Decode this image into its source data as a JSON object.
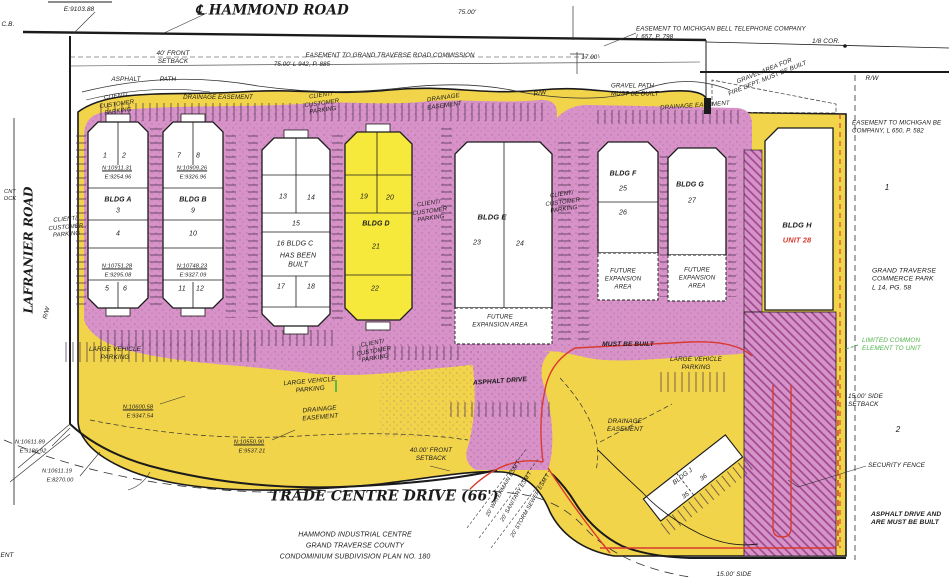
{
  "colors": {
    "site_yellow": "#F2D44B",
    "building_yellow": "#F6E93C",
    "parking_pink": "#D792C8",
    "hatch_line": "#A2418F",
    "ink": "#1B1B1B",
    "red": "#D83A2E",
    "green": "#4FB548"
  },
  "labels": [
    {
      "id": "coord-e9103",
      "text": "E:9103.88",
      "x": 79,
      "y": 10,
      "size": 6.5
    },
    {
      "id": "cb",
      "text": "C.B.",
      "x": 8,
      "y": 25,
      "size": 6.5
    },
    {
      "id": "hammond-road",
      "text": "℄ HAMMOND ROAD",
      "x": 272,
      "y": 11,
      "size": 13.5,
      "family": "serif",
      "weight": 700
    },
    {
      "id": "dim-75",
      "text": "75.00'",
      "x": 467,
      "y": 13,
      "size": 6.5
    },
    {
      "id": "setback-40-top",
      "text": "40' FRONT\nSETBACK",
      "x": 173,
      "y": 58,
      "size": 6.4
    },
    {
      "id": "esmt-road-commission",
      "text": "EASEMENT TO GRAND TRAVERSE ROAD COMMISSION",
      "x": 390,
      "y": 56,
      "size": 6.2
    },
    {
      "id": "esmt-road-ref",
      "text": "75.00'   L 942, P. 885",
      "x": 302,
      "y": 65,
      "size": 6.2
    },
    {
      "id": "esmt-bell-phone",
      "text": "EASEMENT TO MICHIGAN BELL TELEPHONE COMPANY\nL 657, P. 798",
      "x": 636,
      "y": 33,
      "size": 6.2,
      "align": "l"
    },
    {
      "id": "dim-17",
      "text": "17.00'",
      "x": 590,
      "y": 58,
      "size": 6.2
    },
    {
      "id": "cor-eighth",
      "text": "1/8 COR.",
      "x": 826,
      "y": 42,
      "size": 6.5
    },
    {
      "id": "gravel-area",
      "text": "GRAVEL AREA FOR\nFIRE DEPT. MUST BE BUILT",
      "x": 766,
      "y": 75,
      "size": 6.2,
      "rot": -22
    },
    {
      "id": "rw-right",
      "text": "R/W",
      "x": 872,
      "y": 79,
      "size": 6.5
    },
    {
      "id": "gravel-path",
      "text": "GRAVEL PATH\nMUST BE BUILT",
      "x": 611,
      "y": 90,
      "size": 6.2,
      "align": "l"
    },
    {
      "id": "asphalt-top-left",
      "text": "ASPHALT",
      "x": 126,
      "y": 80,
      "size": 6.4
    },
    {
      "id": "path-top-left",
      "text": "PATH",
      "x": 168,
      "y": 80,
      "size": 6.4
    },
    {
      "id": "client-parking-tl",
      "text": "CLIENT/\nCUSTOMER\nPARKING",
      "x": 117,
      "y": 105,
      "size": 6,
      "rot": -8
    },
    {
      "id": "drainage-tl",
      "text": "DRAINAGE EASEMENT",
      "x": 218,
      "y": 98,
      "size": 6.2
    },
    {
      "id": "client-parking-tc",
      "text": "CLIENT/\nCUSTOMER\nPARKING",
      "x": 322,
      "y": 104,
      "size": 6,
      "rot": -8
    },
    {
      "id": "drainage-tc",
      "text": "DRAINAGE\nEASEMENT",
      "x": 444,
      "y": 102,
      "size": 6.2,
      "rot": -8
    },
    {
      "id": "rw-tc",
      "text": "R/W",
      "x": 540,
      "y": 94,
      "size": 6.5,
      "rot": -10
    },
    {
      "id": "drainage-tr",
      "text": "DRAINAGE EASEMENT",
      "x": 695,
      "y": 106,
      "size": 6.2,
      "rot": -4
    },
    {
      "id": "esmt-bell-2",
      "text": "EASEMENT TO MICHIGAN BE\nCOMPANY, L 650, P. 582",
      "x": 852,
      "y": 127,
      "size": 6.2,
      "align": "l"
    },
    {
      "id": "unit-1",
      "text": "1",
      "x": 105,
      "y": 157
    },
    {
      "id": "unit-2",
      "text": "2",
      "x": 124,
      "y": 157
    },
    {
      "id": "a-n1",
      "text": "N:10911.31",
      "x": 117,
      "y": 169,
      "size": 5.7,
      "underline": true
    },
    {
      "id": "a-e1",
      "text": "E:9254.96",
      "x": 118,
      "y": 178,
      "size": 5.7
    },
    {
      "id": "bldg-a",
      "text": "BLDG A",
      "x": 118,
      "y": 201,
      "weight": 700
    },
    {
      "id": "unit-3",
      "text": "3",
      "x": 118,
      "y": 212
    },
    {
      "id": "unit-4",
      "text": "4",
      "x": 118,
      "y": 235
    },
    {
      "id": "a-n2",
      "text": "N:10751.28",
      "x": 117,
      "y": 267,
      "size": 5.7,
      "underline": true
    },
    {
      "id": "a-e2",
      "text": "E:9295.08",
      "x": 118,
      "y": 276,
      "size": 5.7
    },
    {
      "id": "unit-5",
      "text": "5",
      "x": 107,
      "y": 290
    },
    {
      "id": "unit-6",
      "text": "6",
      "x": 125,
      "y": 290
    },
    {
      "id": "unit-7",
      "text": "7",
      "x": 179,
      "y": 157
    },
    {
      "id": "unit-8",
      "text": "8",
      "x": 198,
      "y": 157
    },
    {
      "id": "b-n1",
      "text": "N:10909.26",
      "x": 192,
      "y": 169,
      "size": 5.7,
      "underline": true
    },
    {
      "id": "b-e1",
      "text": "E:9326.96",
      "x": 193,
      "y": 178,
      "size": 5.7
    },
    {
      "id": "bldg-b",
      "text": "BLDG B",
      "x": 193,
      "y": 201,
      "weight": 700
    },
    {
      "id": "unit-9",
      "text": "9",
      "x": 193,
      "y": 212
    },
    {
      "id": "unit-10",
      "text": "10",
      "x": 193,
      "y": 235
    },
    {
      "id": "b-n2",
      "text": "N:10748.23",
      "x": 192,
      "y": 267,
      "size": 5.7,
      "underline": true
    },
    {
      "id": "b-e2",
      "text": "E:9327.09",
      "x": 193,
      "y": 276,
      "size": 5.7
    },
    {
      "id": "unit-11",
      "text": "11",
      "x": 182,
      "y": 290
    },
    {
      "id": "unit-12",
      "text": "12",
      "x": 200,
      "y": 290
    },
    {
      "id": "unit-13",
      "text": "13",
      "x": 283,
      "y": 198
    },
    {
      "id": "unit-14",
      "text": "14",
      "x": 311,
      "y": 199
    },
    {
      "id": "unit-15",
      "text": "15",
      "x": 296,
      "y": 225
    },
    {
      "id": "c-16-name",
      "text": "16 BLDG C",
      "x": 295,
      "y": 245
    },
    {
      "id": "c-built",
      "text": "HAS BEEN\nBUILT",
      "x": 298,
      "y": 261
    },
    {
      "id": "unit-17",
      "text": "17",
      "x": 281,
      "y": 288
    },
    {
      "id": "unit-18",
      "text": "18",
      "x": 311,
      "y": 288
    },
    {
      "id": "unit-19",
      "text": "19",
      "x": 364,
      "y": 198
    },
    {
      "id": "unit-20",
      "text": "20",
      "x": 390,
      "y": 199
    },
    {
      "id": "bldg-d",
      "text": "BLDG D",
      "x": 376,
      "y": 225,
      "weight": 700
    },
    {
      "id": "unit-21",
      "text": "21",
      "x": 376,
      "y": 248
    },
    {
      "id": "unit-22",
      "text": "22",
      "x": 375,
      "y": 290
    },
    {
      "id": "client-parking-de",
      "text": "CLIENT/\nCUSTOMER\nPARKING",
      "x": 430,
      "y": 212,
      "size": 6,
      "rot": -8
    },
    {
      "id": "bldg-e",
      "text": "BLDG E",
      "x": 492,
      "y": 217,
      "size": 7.5,
      "weight": 700
    },
    {
      "id": "unit-23",
      "text": "23",
      "x": 477,
      "y": 244
    },
    {
      "id": "unit-24",
      "text": "24",
      "x": 520,
      "y": 245
    },
    {
      "id": "e-expansion",
      "text": "FUTURE\nEXPANSION AREA",
      "x": 500,
      "y": 321,
      "size": 6.2
    },
    {
      "id": "client-parking-ef",
      "text": "CLIENT/\nCUSTOMER\nPARKING",
      "x": 563,
      "y": 203,
      "size": 6,
      "rot": -8
    },
    {
      "id": "bldg-f",
      "text": "BLDG F",
      "x": 623,
      "y": 175,
      "weight": 700
    },
    {
      "id": "unit-25",
      "text": "25",
      "x": 623,
      "y": 190
    },
    {
      "id": "unit-26",
      "text": "26",
      "x": 623,
      "y": 214
    },
    {
      "id": "f-expansion",
      "text": "FUTURE\nEXPANSION\nAREA",
      "x": 623,
      "y": 279,
      "size": 6.2
    },
    {
      "id": "bldg-g",
      "text": "BLDG G",
      "x": 690,
      "y": 186,
      "weight": 700
    },
    {
      "id": "unit-27",
      "text": "27",
      "x": 692,
      "y": 202
    },
    {
      "id": "g-expansion",
      "text": "FUTURE\nEXPANSION\nAREA",
      "x": 697,
      "y": 278,
      "size": 6.2
    },
    {
      "id": "bldg-h",
      "text": "BLDG H",
      "x": 797,
      "y": 225,
      "size": 7.5,
      "weight": 700
    },
    {
      "id": "unit-28",
      "text": "UNIT 28",
      "x": 797,
      "y": 240,
      "size": 7.5,
      "weight": 700,
      "color": "red"
    },
    {
      "id": "parcel-1",
      "text": "1",
      "x": 887,
      "y": 188,
      "size": 8
    },
    {
      "id": "gt-commerce-park",
      "text": "GRAND TRAVERSE\nCOMMERCE PARK\nL 14, PG. 58",
      "x": 872,
      "y": 280,
      "size": 6.8,
      "align": "l"
    },
    {
      "id": "limited-common",
      "text": "LIMITED COMMON\nELEMENT TO UNIT",
      "x": 862,
      "y": 345,
      "size": 6.4,
      "align": "l",
      "color": "green"
    },
    {
      "id": "side-setback",
      "text": "15.00' SIDE\nSETBACK",
      "x": 848,
      "y": 401,
      "size": 6.4,
      "align": "l"
    },
    {
      "id": "parcel-2",
      "text": "2",
      "x": 898,
      "y": 430,
      "size": 8
    },
    {
      "id": "security-fence",
      "text": "SECURITY FENCE",
      "x": 868,
      "y": 466,
      "size": 6.4,
      "align": "l"
    },
    {
      "id": "asphalt-must-built",
      "text": "ASPHALT DRIVE AND\nARE MUST BE BUILT",
      "x": 871,
      "y": 519,
      "size": 6.6,
      "align": "l",
      "weight": 700
    },
    {
      "id": "lafranier-road",
      "text": "LAFRANIER ROAD",
      "x": 29,
      "y": 250,
      "size": 12,
      "family": "serif",
      "weight": 700,
      "rot": -90
    },
    {
      "id": "cnt-ock",
      "text": "CNT\nOCK",
      "x": 10,
      "y": 196,
      "size": 5.7
    },
    {
      "id": "rw-left",
      "text": "R/W",
      "x": 47,
      "y": 313,
      "size": 6.2,
      "rot": -75
    },
    {
      "id": "client-parking-left",
      "text": "CLIENT/\nCUSTOMER\nPARKING",
      "x": 66,
      "y": 228,
      "size": 6,
      "rot": -5
    },
    {
      "id": "large-vehicle-left",
      "text": "LARGE VEHICLE\nPARKING",
      "x": 115,
      "y": 354,
      "size": 6.4
    },
    {
      "id": "client-parking-cd",
      "text": "CLIENT/\nCUSTOMER\nPARKING",
      "x": 374,
      "y": 352,
      "size": 6,
      "rot": -10
    },
    {
      "id": "large-vehicle-mid",
      "text": "LARGE VEHICLE\nPARKING",
      "x": 310,
      "y": 386,
      "size": 6.4,
      "rot": -5
    },
    {
      "id": "drainage-ml",
      "text": "DRAINAGE\nEASEMENT",
      "x": 320,
      "y": 414,
      "size": 6.4,
      "rot": -5
    },
    {
      "id": "asphalt-drive",
      "text": "ASPHALT DRIVE",
      "x": 500,
      "y": 382,
      "size": 6.6,
      "weight": 700,
      "rot": -4
    },
    {
      "id": "must-be-built",
      "text": "MUST BE BUILT",
      "x": 628,
      "y": 345,
      "size": 6.6,
      "weight": 700
    },
    {
      "id": "large-vehicle-right",
      "text": "LARGE VEHICLE\nPARKING",
      "x": 696,
      "y": 364,
      "size": 6.4
    },
    {
      "id": "drainage-mr",
      "text": "DRAINAGE\nEASEMENT",
      "x": 625,
      "y": 426,
      "size": 6.4
    },
    {
      "id": "n10600",
      "text": "N:10600.58",
      "x": 138,
      "y": 408,
      "size": 5.7,
      "underline": true
    },
    {
      "id": "e9347",
      "text": "E:9347.54",
      "x": 140,
      "y": 417,
      "size": 5.7
    },
    {
      "id": "n10550",
      "text": "N:10550.90",
      "x": 249,
      "y": 443,
      "size": 5.7,
      "underline": true
    },
    {
      "id": "e9537",
      "text": "E:9537.21",
      "x": 252,
      "y": 452,
      "size": 5.7
    },
    {
      "id": "n10611a",
      "text": "N:10611.89",
      "x": 30,
      "y": 443,
      "size": 5.7
    },
    {
      "id": "e9186",
      "text": "E:9186.92",
      "x": 33,
      "y": 452,
      "size": 5.7
    },
    {
      "id": "n10611b",
      "text": "N:10611.19",
      "x": 57,
      "y": 472,
      "size": 5.7
    },
    {
      "id": "e8270",
      "text": "E:8270.00",
      "x": 60,
      "y": 481,
      "size": 5.7
    },
    {
      "id": "setback-40-bottom",
      "text": "40.00' FRONT\nSETBACK",
      "x": 431,
      "y": 455,
      "size": 6.4
    },
    {
      "id": "trade-centre-drive",
      "text": "TRADE CENTRE DRIVE (66')",
      "x": 384,
      "y": 497,
      "size": 14,
      "family": "serif",
      "weight": 700
    },
    {
      "id": "title-line-1",
      "text": "HAMMOND INDUSTRIAL CENTRE",
      "x": 355,
      "y": 536
    },
    {
      "id": "title-line-2",
      "text": "GRAND TRAVERSE COUNTY",
      "x": 355,
      "y": 547
    },
    {
      "id": "title-line-3",
      "text": "CONDOMINIUM SUBDIVISION PLAN NO. 180",
      "x": 355,
      "y": 558
    },
    {
      "id": "esmt-watermain",
      "text": "20' WATERMAIN ESM'T",
      "x": 504,
      "y": 489,
      "size": 5.7,
      "rot": -60
    },
    {
      "id": "esmt-sanitary",
      "text": "20' SANITARY ESM'T",
      "x": 517,
      "y": 497,
      "size": 5.7,
      "rot": -60
    },
    {
      "id": "esmt-storm",
      "text": "20' STORM SEWER ESM'T",
      "x": 531,
      "y": 506,
      "size": 5.7,
      "rot": -60
    },
    {
      "id": "bldg-j",
      "text": "BLDG J",
      "x": 683,
      "y": 477,
      "size": 6.4,
      "rot": -38
    },
    {
      "id": "unit-36",
      "text": "36",
      "x": 704,
      "y": 478,
      "size": 6.4,
      "rot": -38
    },
    {
      "id": "unit-35",
      "text": "35",
      "x": 686,
      "y": 496,
      "size": 6.4,
      "rot": -38
    },
    {
      "id": "side-15",
      "text": "15.00' SIDE",
      "x": 734,
      "y": 575,
      "size": 6.4
    },
    {
      "id": "ent-fragment",
      "text": "ENT",
      "x": 7,
      "y": 556,
      "size": 6.4
    }
  ]
}
